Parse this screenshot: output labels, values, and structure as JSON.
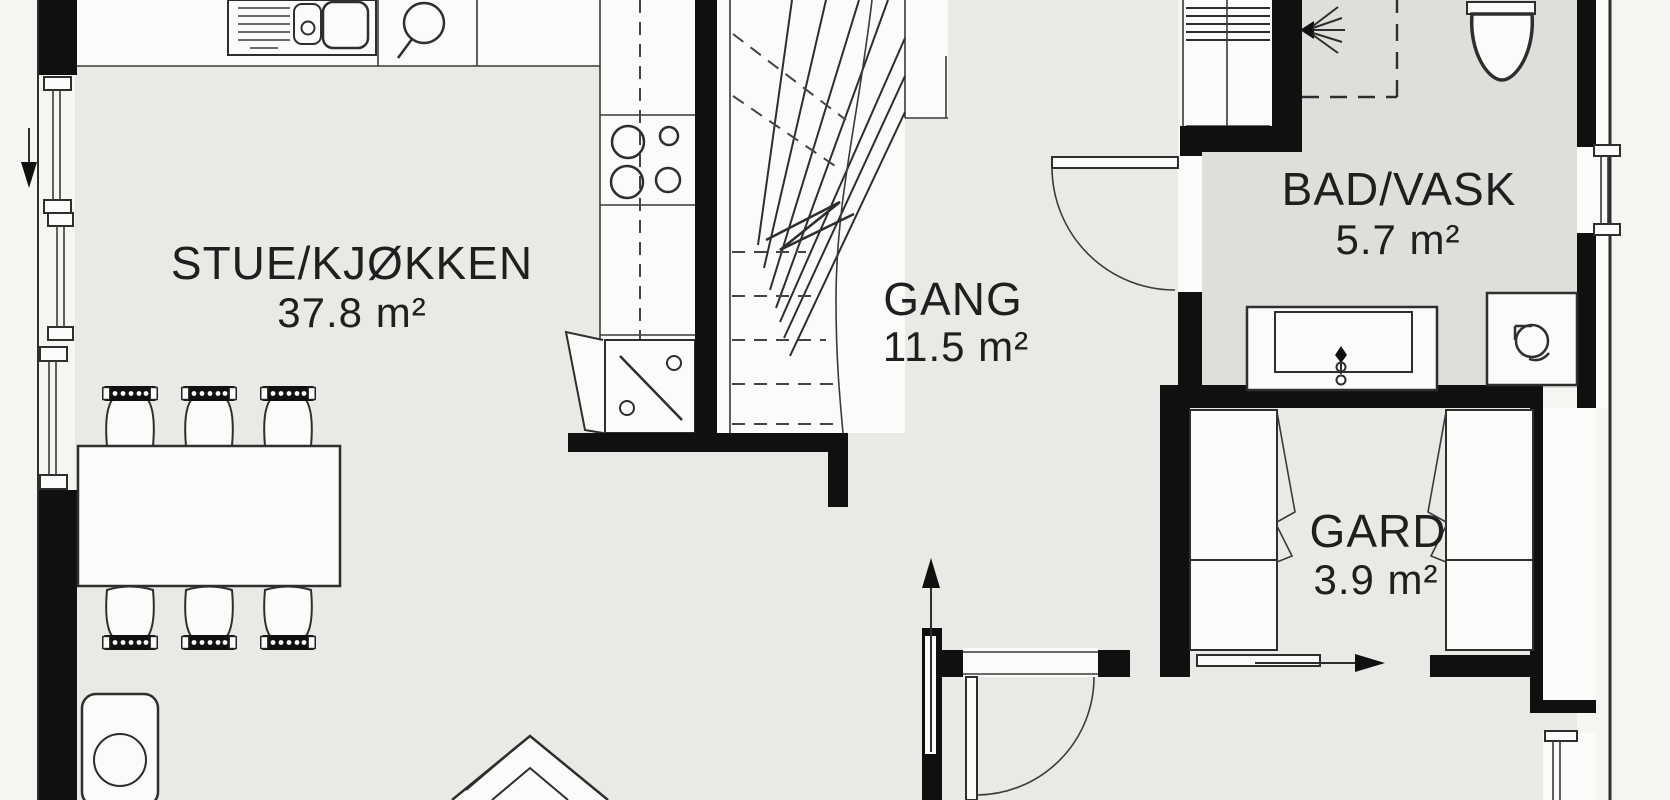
{
  "plan": {
    "type": "floor-plan",
    "rooms": [
      {
        "id": "stue-kjokken",
        "name": "STUE/KJØKKEN",
        "area": "37.8 m²"
      },
      {
        "id": "gang",
        "name": "GANG",
        "area": "11.5 m²"
      },
      {
        "id": "bad-vask",
        "name": "BAD/VASK",
        "area": "5.7 m²"
      },
      {
        "id": "gard",
        "name": "GARD",
        "area": "3.9 m²"
      }
    ],
    "symbols": [
      "kitchen-sink",
      "cooktop",
      "dishwasher",
      "stairs",
      "shower",
      "toilet",
      "vanity-sink",
      "washing-machine",
      "dining-table",
      "chairs",
      "armchair",
      "fireplace",
      "wardrobes",
      "windows",
      "door-swings",
      "direction-arrows"
    ],
    "colors": {
      "wall": "#101010",
      "ink": "#1f1f1f",
      "line": "#2e2e2e",
      "floor": "#ebe9e5",
      "wet": "#dfdedb",
      "white": "#fcfbf9",
      "bg": "#f6f5f2"
    }
  }
}
